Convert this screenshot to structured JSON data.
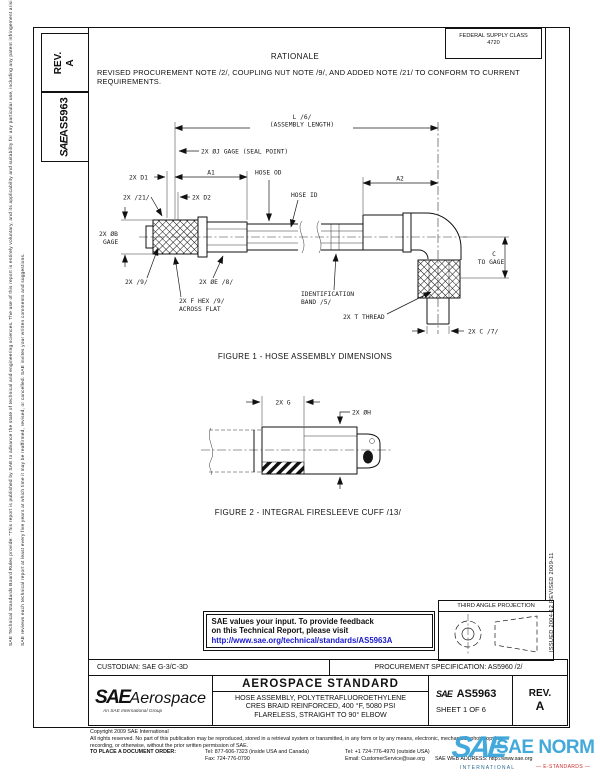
{
  "margins": {
    "disclaimer_primary": "SAE Technical Standards Board Rules provide: \"This report is published by SAE to advance the state of technical and engineering sciences. The use of this report is entirely voluntary, and its applicability and suitability for any particular use, including any patent infringement arising therefrom, is the sole responsibility of the user.\"",
    "disclaimer_secondary": "SAE reviews each technical report at least every five years at which time it may be reaffirmed, revised, or cancelled. SAE invites your written comments and suggestions.",
    "issued_revised": "ISSUED 2004-12        REVISED 2009-11",
    "rev_label": "REV.",
    "rev_value": "A",
    "sae_mark": "SAE",
    "doc_number": "AS5963"
  },
  "header": {
    "fsc_title": "FEDERAL SUPPLY CLASS",
    "fsc_code": "4720",
    "rationale_heading": "RATIONALE",
    "rationale_body": "REVISED PROCUREMENT NOTE /2/, COUPLING NUT NOTE /9/, AND ADDED NOTE /21/ TO CONFORM TO CURRENT REQUIREMENTS."
  },
  "figure1": {
    "caption": "FIGURE 1 - HOSE ASSEMBLY DIMENSIONS",
    "labels": {
      "length_code": "L /6/",
      "length_name": "(ASSEMBLY LENGTH)",
      "gage_seal": "2X ØJ GAGE (SEAL POINT)",
      "d1": "2X D1",
      "a1": "A1",
      "hose_od": "HOSE OD",
      "hose_id": "HOSE ID",
      "a2": "A2",
      "note_21": "2X /21/",
      "d2": "2X D2",
      "gage_b_1": "2X ØB",
      "gage_b_2": "GAGE",
      "note_9": "2X /9/",
      "dia_e": "2X ØE /8/",
      "hex_1": "2X F HEX /9/",
      "hex_2": "ACROSS FLAT",
      "band_1": "IDENTIFICATION",
      "band_2": "BAND /5/",
      "c_1": "C",
      "c_2": "TO GAGE",
      "thread": "2X T THREAD",
      "c_7": "2X C /7/"
    }
  },
  "figure2": {
    "caption": "FIGURE 2 - INTEGRAL FIRESLEEVE CUFF /13/",
    "labels": {
      "g": "2X G",
      "dia_h": "2X ØH"
    }
  },
  "feedback": {
    "line1": "SAE values your input. To provide feedback",
    "line2": "on this Technical Report, please visit",
    "url": "http://www.sae.org/technical/standards/AS5963A"
  },
  "projection": {
    "title": "THIRD ANGLE PROJECTION"
  },
  "title_block": {
    "custodian": "CUSTODIAN: SAE G-3/C-3D",
    "procurement": "PROCUREMENT SPECIFICATION: AS5960 /2/",
    "brand": {
      "sae": "SAE",
      "name": "Aerospace",
      "tagline": "An SAE International Group"
    },
    "standard_heading": "AEROSPACE STANDARD",
    "title_lines": {
      "l1": "HOSE ASSEMBLY, POLYTETRAFLUOROETHYLENE",
      "l2": "CRES BRAID REINFORCED, 400 °F, 5080 PSI",
      "l3": "FLARELESS, STRAIGHT TO 90° ELBOW"
    },
    "doc": {
      "sae": "SAE",
      "number": "AS5963",
      "sheet": "SHEET 1 OF 6"
    },
    "rev": {
      "label": "REV.",
      "value": "A"
    }
  },
  "footer": {
    "copyright": "Copyright 2009 SAE International",
    "rights1": "All rights reserved. No part of this publication may be reproduced, stored in a retrieval system or transmitted, in any form or by any means, electronic, mechanical, photocopying,",
    "rights2": "recording, or otherwise, without the prior written permission of SAE.",
    "order_label": "TO PLACE A DOCUMENT ORDER:",
    "tel_inside": "Tel: 877-606-7323 (inside USA and Canada)",
    "tel_outside": "Tel: +1 724-776-4970 (outside USA)",
    "fax": "Fax: 724-776-0790",
    "email": "Email: CustomerService@sae.org",
    "web": "SAE WEB ADDRESS: http://www.sae.org"
  },
  "watermark": {
    "mark": "SAE",
    "name": "SAE NORM",
    "sub_left": "INTERNATIONAL",
    "sub_right": "— E-STANDARDS —"
  }
}
